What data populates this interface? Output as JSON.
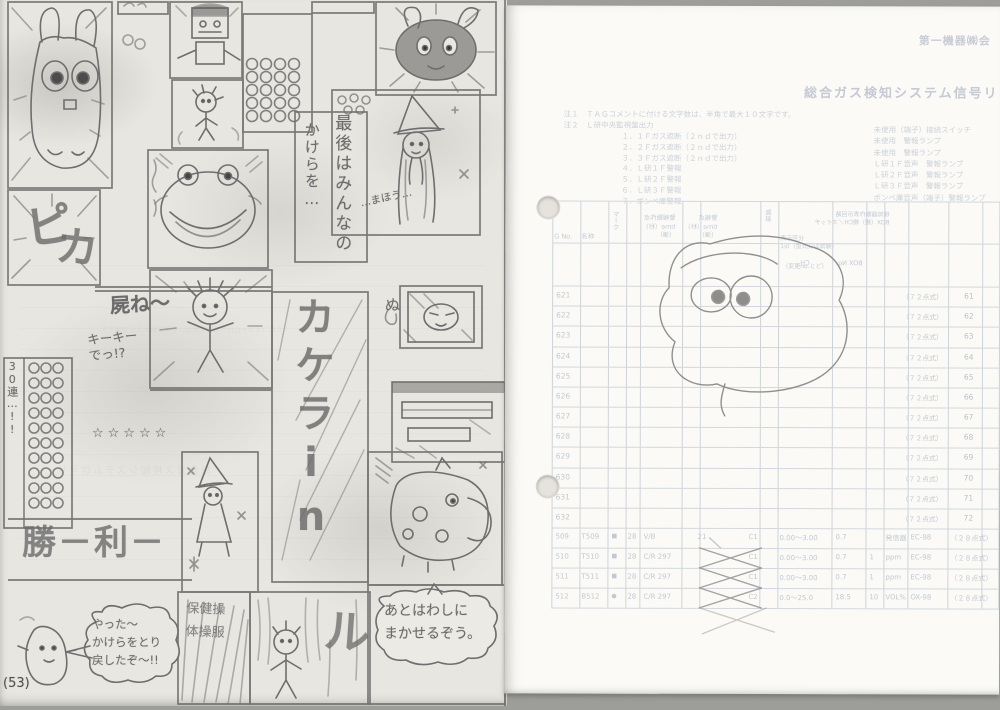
{
  "scan": {
    "page_number": "(53)",
    "manga": {
      "texts": {
        "saigo_line1": "最後はみんなの",
        "saigo_line2": "かけらを…",
        "kakera_big": "カケラin",
        "pika1": "ピ",
        "pika2": "カ",
        "shine": "屍ね〜",
        "kiki": "キーキー\nでっ!?",
        "shouri": "勝－利－",
        "stars": "☆☆☆☆☆",
        "renpatsu": "30連…!!",
        "mahou": "…まほう…",
        "nu": "ぬ",
        "ru": "ル",
        "yatta": "やった〜\nかけらをとり\n戻したぞ〜!!",
        "makaseru": "あとはわしに\nまかせるぞう。",
        "hoken": "保健操\n体操服"
      }
    },
    "page2": {
      "corner": "第一機器㈱会",
      "title": "総合ガス検知システム信号リ",
      "notes": {
        "n1_label": "注１",
        "n1": "ＴＡＧコメントに付ける文字数は、半角で最大１０文字です。",
        "n2_label": "注２",
        "n2": "Ｌ研中央監視盤出力",
        "list": [
          "１．１Ｆガス遮断（２ｎｄで出力）",
          "２．２Ｆガス遮断（２ｎｄで出力）",
          "３．３Ｆガス遮断（２ｎｄで出力）",
          "４．Ｌ研１Ｆ警報",
          "５．Ｌ研２Ｆ警報",
          "６．Ｌ研３Ｆ警報",
          "７．ボンベ庫警報"
        ],
        "right_list": [
          "未使用（端子）接続スイッチ",
          "未使用　警報ランプ",
          "未使用　警報ランプ",
          "Ｌ研１Ｆ音声　警報ランプ",
          "Ｌ研２Ｆ音声　警報ランプ",
          "Ｌ研３Ｆ音声　警報ランプ",
          "ボンベ庫音声（端子）警報ランプ"
        ]
      },
      "table": {
        "header_labels": [
          {
            "text": "G No."
          },
          {
            "text": "名称"
          },
          {
            "text": "マーク",
            "vertical": true
          },
          {
            "text": "警報動作点",
            "sub": "time（秒）\n（値）",
            "mirrored": true
          },
          {
            "text": "警報点",
            "sub": "time（秒）\n（値）",
            "mirrored": true
          },
          {
            "text": "遅延",
            "vertical": true
          },
          {
            "text": "表示区分",
            "sub": "1st（型式又は試験）"
          },
          {
            "text": "（変更no.とど）"
          },
          {
            "text": "検知器動作表示回路",
            "sub": "BOX（親）親CH／スイッチ",
            "mirrored": true
          },
          {
            "text": "CH",
            "mirrored": true
          },
          {
            "text": "BOX No.",
            "mirrored": true
          }
        ],
        "rows": [
          {
            "g": "621",
            "note": "（７２点式）",
            "ch": "61"
          },
          {
            "g": "622",
            "note": "（７２点式）",
            "ch": "62"
          },
          {
            "g": "623",
            "note": "（７２点式）",
            "ch": "63"
          },
          {
            "g": "624",
            "note": "（７２点式）",
            "ch": "64"
          },
          {
            "g": "625",
            "note": "（７２点式）",
            "ch": "65"
          },
          {
            "g": "626",
            "note": "（７２点式）",
            "ch": "66"
          },
          {
            "g": "627",
            "note": "（７２点式）",
            "ch": "67"
          },
          {
            "g": "628",
            "note": "（７２点式）",
            "ch": "68"
          },
          {
            "g": "629",
            "note": "（７２点式）",
            "ch": "69"
          },
          {
            "g": "630",
            "note": "（７２点式）",
            "ch": "70"
          },
          {
            "g": "631",
            "note": "（７２点式）",
            "ch": "71"
          },
          {
            "g": "632",
            "note": "（７２点式）",
            "ch": "72"
          }
        ],
        "bottom_rows": [
          {
            "g": "509",
            "tag": "T509",
            "mark": "■",
            "n": "28",
            "code": "V/B",
            "d1": "21",
            "box": "C1",
            "range": "0.00〜3.00",
            "set": "0.7",
            "mult": "",
            "unit": "発信器",
            "det": "EC-98",
            "note": "（２８点式）"
          },
          {
            "g": "510",
            "tag": "T510",
            "mark": "■",
            "n": "28",
            "code": "C/R 297",
            "d1": "",
            "box": "C1",
            "range": "0.00〜3.00",
            "set": "0.7",
            "mult": "1",
            "unit": "ppm",
            "det": "EC-98",
            "note": "（２８点式）"
          },
          {
            "g": "511",
            "tag": "T511",
            "mark": "■",
            "n": "28",
            "code": "C/R 297",
            "d1": "",
            "box": "C1",
            "range": "0.00〜3.00",
            "set": "0.7",
            "mult": "1",
            "unit": "ppm",
            "det": "EC-98",
            "note": "（２８点式）"
          },
          {
            "g": "512",
            "tag": "B512",
            "mark": "●",
            "n": "28",
            "code": "C/R 297",
            "d1": "",
            "box": "C2",
            "range": "0.0〜25.0",
            "set": "18.5",
            "mult": "10",
            "unit": "VOL%",
            "det": "OX-98",
            "note": "（２８点式）"
          }
        ]
      }
    }
  }
}
